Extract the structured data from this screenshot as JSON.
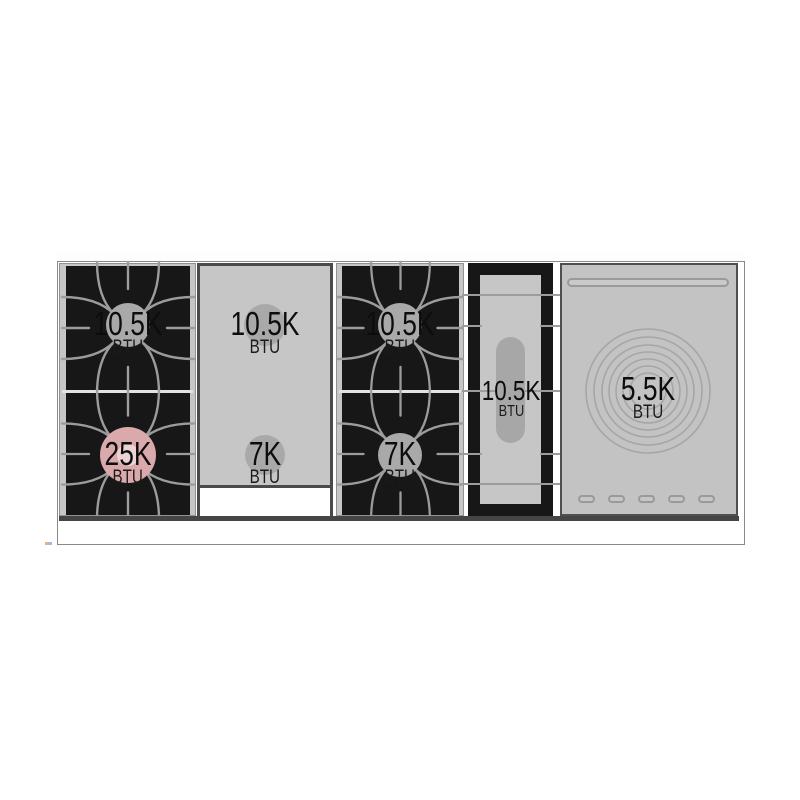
{
  "diagram": {
    "kind": "range-cooktop-burner-layout",
    "burners": {
      "left_top": {
        "value": "10.5K",
        "unit": "BTU"
      },
      "left_bottom": {
        "value": "25K",
        "unit": "BTU"
      },
      "griddle_top": {
        "value": "10.5K",
        "unit": "BTU"
      },
      "griddle_bottom": {
        "value": "7K",
        "unit": "BTU"
      },
      "center_top": {
        "value": "10.5K",
        "unit": "BTU"
      },
      "center_bottom": {
        "value": "7K",
        "unit": "BTU"
      },
      "oval": {
        "value": "10.5K",
        "unit": "BTU"
      },
      "french_top": {
        "value": "5.5K",
        "unit": "BTU"
      }
    },
    "colors": {
      "surface_gray": "#c6c6c6",
      "frame_black": "#171717",
      "grate_line": "#9c9c9c",
      "burner_disc_gray": "#a9a9a9",
      "power_burner_pink": "#d9a9ac",
      "outline_gray": "#8a8a8a"
    }
  }
}
